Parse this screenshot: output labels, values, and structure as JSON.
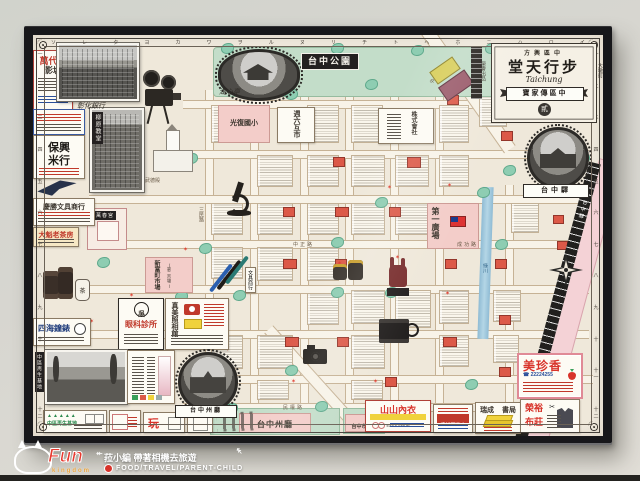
{
  "watermark": {
    "brand": "Fun",
    "brand_sub": "kingdom",
    "line1": "菈小編 帶著相機去旅遊",
    "line2": "FOOD/TRAVEL/PARENT-CHILD"
  },
  "poster": {
    "title_block": {
      "top_label": "方輿區中",
      "title": "堂天行步",
      "subtitle": "Taichung",
      "banner": "寶家傳區中",
      "seal": "貳",
      "left_vertical": "榮譽出品",
      "right_vertical": "大墩町"
    },
    "border": {
      "top_kana": [
        "ソ",
        "レ",
        "タ",
        "ヨ",
        "カ",
        "ワ",
        "ヲ",
        "ル",
        "ヌ",
        "リ",
        "チ",
        "ト",
        "ヘ",
        "ホ",
        "ニ",
        "ハ",
        "ロ",
        "イ"
      ],
      "side_numerals": [
        "一",
        "二",
        "三",
        "四",
        "五",
        "六",
        "七",
        "八",
        "九",
        "十",
        "十一",
        "十二"
      ]
    },
    "landmarks": {
      "park_label": "台中公園",
      "pavilion_caption": "湖心亭",
      "station_ribbon": "台中驛",
      "railway_label": "台中驛",
      "hall_ribbon": "台中州廳",
      "school_block": "光復國小",
      "market_block": "新富町市場",
      "market_sub": "(第二市場)",
      "plaza_block": "第一廣場",
      "temple_label": "萬春宮",
      "dojo_label": "武德殿",
      "hall_block": "台中州廳",
      "cityhall_block": "台中市役所",
      "company_block": "株式會社",
      "saturday_block": "週六互市",
      "church_label": "柳原教堂",
      "bank_caption": "彰化銀行",
      "river_label": "綠川",
      "stationery_sign": "文具商行"
    },
    "streets": {
      "sanmin": "三民路",
      "zhongzheng": "中正路",
      "zhongshan": "中山路",
      "chenggong": "成功路",
      "minquan": "民權路"
    },
    "ads": {
      "cinema": {
        "name": "萬代福",
        "sub": "影城"
      },
      "rice": {
        "name": "保興",
        "sub": "米行"
      },
      "stationery": {
        "name": "慶勝文具商行"
      },
      "tea_house": {
        "name": "大魁老茶房"
      },
      "watch": {
        "name": "四海鐘錶"
      },
      "eye_clinic": {
        "badge": "吳",
        "name": "眼科診所"
      },
      "photo_studio": {
        "name": "真美照相館"
      },
      "underwear": {
        "name": "山山內衣",
        "sub": "EASY SHOP"
      },
      "herb": {
        "name": "清祺百草店"
      },
      "bookstore": {
        "name": "瑞成",
        "sub": "書局"
      },
      "bakery": {
        "name": "美珍香",
        "phone": "☎ 22224255"
      },
      "fabric": {
        "name": "榮裕",
        "sub": "布莊"
      },
      "base": {
        "name": "中區再生基地"
      }
    },
    "bottom_strip": {
      "regen_label": "中區再生基地",
      "fun_logo": "玩"
    },
    "jar_char": "茶"
  }
}
